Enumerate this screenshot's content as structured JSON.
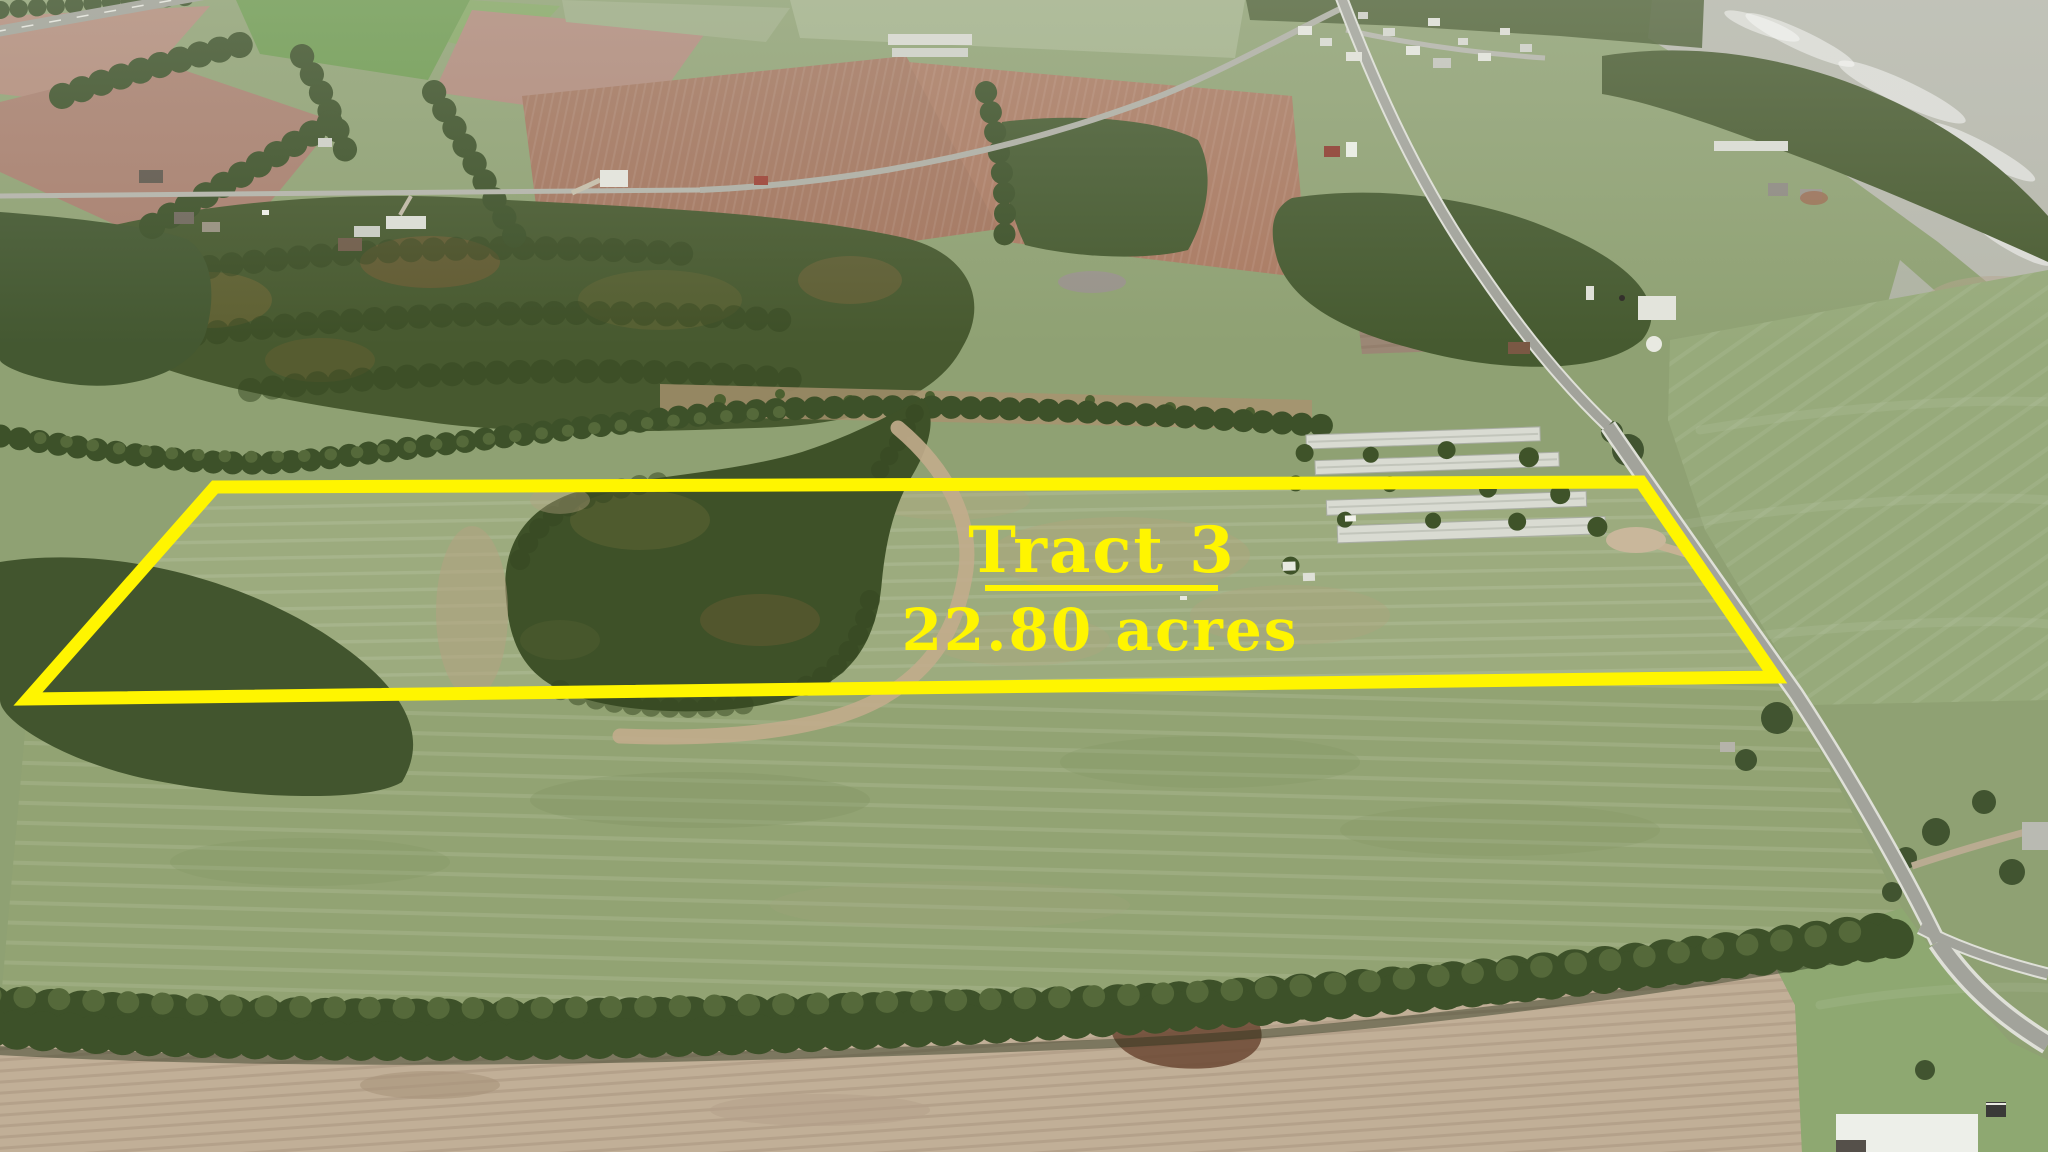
{
  "overlay": {
    "tract_name": "Tract 3",
    "acreage": "22.80 acres",
    "boundary_color": "#FFF500",
    "label_color": "#FFF500"
  },
  "palette": {
    "pasture_green": "#8FA173",
    "tract_pasture_green": "#9CAB7E",
    "forest_green": "#44582F",
    "plowed_field_brown": "#A3755E",
    "plowed_field_mauve": "#A87F6E",
    "bare_dirt_tan": "#C1AF97",
    "harvested_field_gray": "#B8B9AE",
    "road_gray": "#A2A39B",
    "road_edge_white": "#DFE0D8",
    "barn_roof_white": "#D9DBD2"
  }
}
